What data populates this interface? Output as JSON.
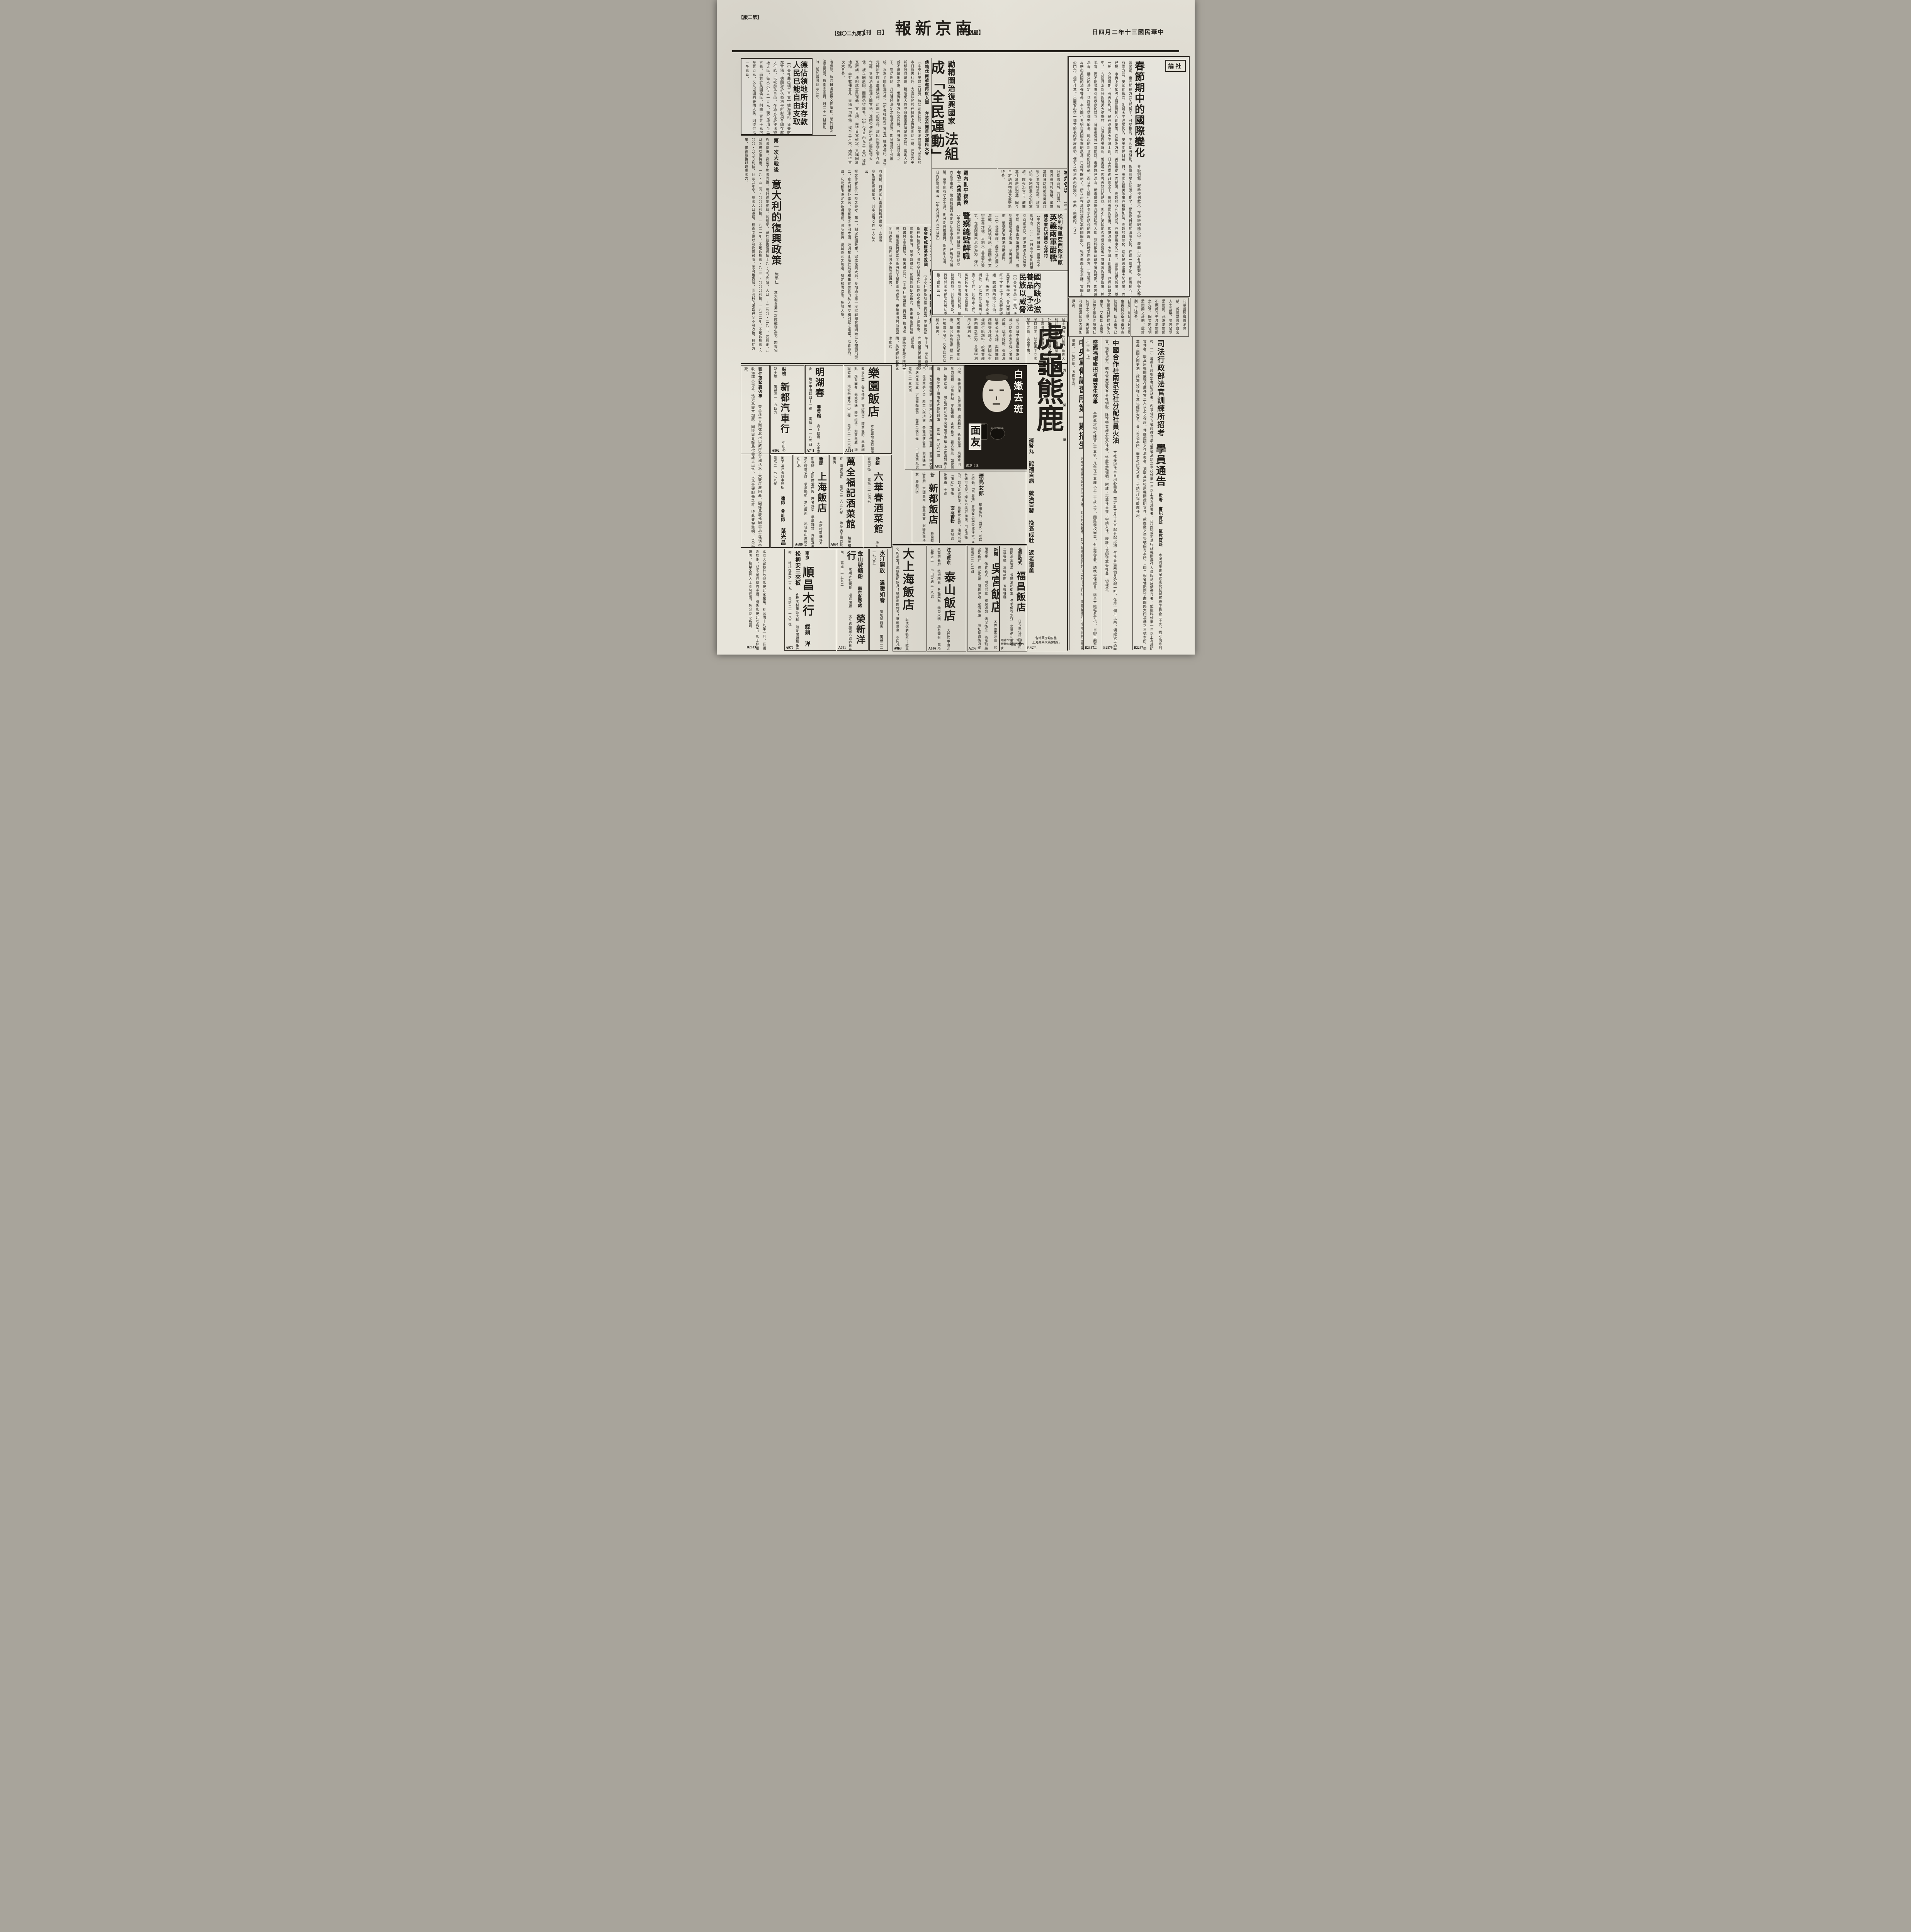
{
  "page": {
    "edition": "【版二第】",
    "issue": "【號〇二九第】",
    "daily": "【刊　日】",
    "masthead": "報新京南",
    "weekday": "【二期星】",
    "date": "日四月二年十三國民華中"
  },
  "editorial": {
    "label": "論社",
    "title": "春節期中的國際變化",
    "body": "春節例假、報紙停刊數天、在短短的幾天中、表面上沒有什麼緊張、則各方都非常緊張、重要的幾方面的局勢中、可以推測、不久便將發動、觀察歐局的決勝之期了、是歐局目前的決勝大勢、在這一個季節、德義軸心、祇有兩方面、英國的戰面、則是太平洋局勢的。英美關係日甚一日、美國的援英政策亦積極加強、而趨於白熱化。這便是甚麼重大的結果、內亂已極、事實上更加強了羅國對軸心的依附。在歐洲方面、英國縱使一面稱勝、而趨於有利的局面、亦祇是戰事的一面、三國同盟的效果、並非一朝一夕所可期、英美的利益、是在遠東與太平洋上的。日本在南進政策之下、對於美國的態度、頗堪注意、太平洋上的風雲、已在醞釀之中。一方面日本新任的駐美大使野村、已兼程赴美履新、他抱着一腔與美修好的熱忱、但不知美國能否覺悟改變他一貫陳舊的遠東政策、抓住現實、而不阻撓東亞新秩序的建立、目前卻還是一個問題。春節旣已過去、新春隨着陽光而駕臨到人間、預料歐洲醞釀準備的時期、卽將成爲過去、勝負的決定、也許就在這個季節裏、軸心的新攻勢卽將發動、而日本方面也處處表示出積極的態度、同時東西兩方、正是遙相呼應、更反映出美國的加強援英、本方面也看明白英國未來的厄運、已經在眼前了。所以說在這短短幾天裏的國際變化、雖然表面上很平靜、實際上鈎心鬥角、極可注意。只要留心這一個季節裏的發展形勢、便可以知道未來的變化、是未可樂觀的。（Ｊ）"
  },
  "news": {
    "german": {
      "t1": "德佔領地所封存款",
      "t2": "人民已能自由支取",
      "body": "【中央社華盛頓三日電】據海通訊、據美財部宣稱、德國對於佔領地帶所封鎖各國存款之付給、已較前爲自由、在過去住於被佔領地人民、每人只付以一百元、現已增加至二百元、而對於美國僑民、則由二百五十元增至五百元、又凡返國的美國人民、則特付以一千元云、"
    },
    "wirea": {
      "body": "海通訊、據昨日法報撰文佈論稱、關於首次法國民議、鉄衛團團員、月二十一日暴動時、前於曾將計三〇年。"
    },
    "italy": {
      "kicker": "第一次大戰後",
      "title": "意大利的復興政策",
      "author": "施學仁",
      "body": "意大利自第一次歐戰發生後、卽與協約國聯絡、背棄了三國同盟、而對德奧宣戰、其結果、得於戰後獲得領土九・〇〇五哩、人口一・三七〇・二九一、宣戰後、其財政賴以維持者、一九・五三四・〇〇〇利拉、一九二一年、不足數爲五・九二二・〇〇〇利拉、一九二二年、不足數爲五・〇〇〇・〇〇〇利拉、計三〇年來、意國人口激增、糧食問題以及物價飛漲、國府雖告誡、而消耗的遷延已至不可收拾、對症方策、俟復戰後以培養國力、",
      "body2": "撰文作者並供一時之參考、第一、制定救國政策、完成復興大局、參加過之第一次歐戰和食糧問題以及物價飛漲、二、意大利旅外僑民、常有鉅金匯回本國、近因禁止屬於娛樂和集會性質的私人房屋和別墅之建築、以資節約、四、凡元首所決定之各項措置、同時並供一復興作者之無過、制定救國政策、參加大局、"
    },
    "france": {
      "kicker": "勵精圖治復興國家",
      "title": "法組成「全民運動」",
      "sub1": "傳賴伐爾被邀再度入閣",
      "sub2": "幷將召開首次國民大會",
      "body": "【中央社里昂二日電】據哈瓦斯社訊、法某消息靈通方面頃於本日發表社評、力言法民族在精神上實屬團結一致、巴黎若干報紙所持論調、雖或使人感覺自由區與淪陷區之間、兩地人民咸不無隔閡之處、但實則雙方完全諒解、在貝當元首領導之下、密切團結、凡元首所決定之各項措置、卽使性質十分嚴峻、亦爲全國所遵行云、【中央社維希三日電】據海通訊、貝當元帥原定昨日廣播演詞、討論一般政局、旋因巴黎發生事件而作罷、又據消息靈通方面宣稱、達朗公使原定赴巴黎晤德大使、旋以同原因、因而仍留維希、【中央社日內瓦二日電】據哈瓦斯講、法組成全民運動、會日期、尚待貝當確定、又稱關於地點、尚有數種意見、末稱一切準備、或至二月末、始舉行首次大會云、"
    },
    "rome": {
      "kicker": "羅內亂平復後",
      "title": "警察總監解職",
      "sub": "有功士兵感獲重獎",
      "body": "【中央社羅馬三日電】羅馬尼亞內亂平復後、警察總監以未能防止亂事發生、已被明令解職、至平亂有功之士兵、則分別感獲重獎、聞內閣人選、日內卽可發表云、【中央社日內瓦二日電】"
    },
    "denmark": {
      "t1": "丹國社黨",
      "t2": "黨徒增多",
      "body": "【中央社丹麥京城三日電】丹麥國社黨昨向丹麥政府宣稱、丹麥國社黨黨徒現已增多、去歲有參加暴動而被捕者、其中並有女性一人在內云、"
    },
    "willkie": {
      "t1": "威爾基訪視",
      "t2": "英被炸各城",
      "body": "【中央社瑞典京城三日電】據得自倫敦報告稱、威爾基昨日訪視被德機轟炸後之戈文特里城、旋又訪視受創頗重之伯明罕城、昨夜迄今日、威爾基住於羅斯烈堡、聞今日將訪利物浦及曼徹斯特云、"
    },
    "nutrition": {
      "t1": "國內缺少滋養品",
      "t2": "予法民族以威脅",
      "body": "【中央社里昂二日電】法某著名醫學家、曾向美國紅十字會工作人員發表談話、略謂國內缺少牛油、牛乳、朱古力、苟不設法補救、足以危及法蘭西民族之生存、其爲害之甚、將較數千年來之戰爭爲烈、故我國現行局勢、倘聽其自然、其影響所及、行見我國子孫陷於萬劫不復之境地云云、"
    },
    "eritrea": {
      "kicker": "埃利特里亞西部平原",
      "title": "英義兩軍酣戰",
      "sub": "傳英軍已佔據亞戈達特",
      "body": "【中央社羅馬三日電】義軍司令部發表、（一）一日東非埃利特里亞西部平原、阿戈爾達多已倫支中間、我軍與英軍展開激戰、義空軍援助地上義軍、以機槍掃射、擊潰英軍陣地移動部隊、（二）北非戰線、義軍在巴爾之激戰、又路透社訊、此間宣布英空軍轟炸機、星期六日冒惡劣天氣、復襲阿爾巴尼亞海港、彈中倉庫與軍火庫等目標、"
    },
    "donovan": {
      "kicker": "美特使鄧洛文",
      "title": "留土京候晤總統",
      "sub": "霍金斯威爾基將返國",
      "body": "【中央社伊斯坦堡三日電】美總統羅斯福特使鄧洛文、將於今日與土外長作首次會談、及土總統事、統伊斯麥時、尚不致離此、謠傳鄧特使之留此、係銜羅斯福總統持書與土國首領、故未離此云、【中央社華盛頓三日電】據海通訊、羅斯福特使霍金斯將於下星期由英返國、衆信渠將與威爾基同時返國、羅氏並將予彼等要職云、"
    },
    "pacific": {
      "kicker": "共同防衛南太平洋",
      "title": "美澳新已成立諒解",
      "body": "【中央社紐約三日電】「紐約泰晤士報」載稱、美澳新西蘭間、似已成立以日本南進政策爲目標之防衛南太平洋之某種諒解、此項諒解、係澳洲駐美公使克錫、與赫爾國務卿交涉成功、美國似有權利供給燃料、設備東部新西蘭之軍港、並獲得利用之權利云、"
    },
    "airwar": {
      "title": "英領空又有猛戰",
      "body": "【中央社瑞典京城三日電】據英國廣播公司宣稱、英吉利海峽及英格蘭南岸、發生激烈空戰、詳情未悉、【中央社柏林二日電】德軍司令部發表稱、德空軍一日又空襲英本土、轟炸空軍根據地兩處、炸毀敵轟炸機多架、此外轟炸英格蘭東南部重要軍事目標、擊沉英商船三艘（共計萬四千噸）、又予其餘以極大損害、"
    },
    "manchu": {
      "t1": "滿洲駐義大使",
      "t2": "前日呈遞國書",
      "body": "【中央社羅馬二日電】滿洲國新任駐義公使羅振邦、二日上午十時、至納萊宮、向義皇愛麥棱三世呈遞國書、"
    },
    "ships": {
      "t1": "美將沒收",
      "t2": "軸心船舶",
      "body": "【中央社紐約一日電】美將於最近沒收停泊美港之軸心國船舶、近因義國僑民常有鉅金匯回本國、美政府對此甚爲注意云、"
    },
    "genoa": {
      "kicker": "義方鄭重否認",
      "title": "封閉熱那亞港",
      "body": "【中央社瑞士京城三日電】據義大利駐外使館鄭重否認稱、外報所稱熱那亞港、西地中海將有戰事發生、義將予以封閉、禁止與中立國船舶之說、完全不確、"
    },
    "gusang": {
      "kicker": "谷桑將軍表明",
      "title": "瑞士國防雄厚",
      "body": "【中央社瑞士京城三日電】據瑞士最高軍事長官谷桑將軍發表談話稱、瑞士軍隊已準備應付任何可能的事態、又稱瑞士軍隊決無不抵抗而放棄任何領土之意、末稱渠可自信其國防力量加厚矣、"
    },
    "whitehouse": {
      "kicker": "白宮人士盛傳",
      "title": "英將佔愛爾蘭",
      "body": "【中央社紐約三日電】據昨晚「紐約詢報」刊華盛頓傳來消息稱、威爾基曾向白宮人士宣稱、英將佔領愛爾蘭、此爲愛爾蘭不願威氏干涉愛爾蘭之先聲、聞英將佔領愛爾蘭之計劃、此計劃已打消云、"
    }
  },
  "notices": {
    "judicial": {
      "t1": "司法行政部法官訓練所招考",
      "t2": "學員通告",
      "roles": "監考　書記官班　監獄官班",
      "body": "本所招考書記官班及監獄官班學員各三十名、招考簡章列後、（一）等學力經檢定考試及格者、丙曾在公立或經教育部立案或承認之學校修業一年以上得有證書者、已法院或司法行政機關委任人員服務成績優良者、監獄科修業一年以上有證明文件者、取具原機關或現任薦任官二人以上之保證、件應證明文件遺失者、須取具原校原機關證明文件、款應繳文憑掛號函寄本所、（四）報名地點南京瞻園路大四福巷之三號本所、甲黨義乙國文丙史地丁政治戊法律大意已經濟大意、員可寄宿本所、畢業考試及格者、呈請司法行政部任用、",
      "code": "B2257"
    },
    "coop": {
      "title": "中國合作社南京支社分配社員火油",
      "body": "本社專辦社員日用必需品、茲定於本月十八日起分配火油、每社員每兩個月分配一听、在第一個月以內、領證後以憑購買、現暫規定、聽在營業部及各分社領取、除在營業部及各分社外、特此登報週知、附註：再非社員亦可申請入社、經許可後卽得享受社員一切權益、",
      "code": "B2879"
    },
    "shengxifu": {
      "title": "盛錫福帽廠招考練習生啓事",
      "body": "本廠此次招考練習生十五名、凡年在十五歲以上二十歲以下、國民學校畢業、有志學習者、請携帶保證書、逕至本廠報名可也、自卽日起至一月十五日止、",
      "code": "B2357"
    },
    "institute": {
      "title": "中央宣傳講習所第一期招生",
      "body": "凡中學畢業或具有同等學力者、均可報名投考、報名日期自卽日起至二月十五日止、附繳最近四寸半身照片及畢業證書、一切詳章、函索卽寄、"
    }
  },
  "ads": {
    "tiger": {
      "c1": "虎",
      "c2": "龜",
      "c3": "熊",
      "c4": "鹿",
      "i1": "富",
      "i2": "貴",
      "i3": "榮",
      "i4": "華",
      "pill": "補腎丸",
      "s1": "能補百病",
      "s2": "統治百發",
      "s3": "挽衰成壯",
      "s4": "返老還童",
      "f1": "各埠藥房均有售",
      "f2": "上海美藥大藥房發行",
      "code": "B2575"
    },
    "face": {
      "headline": "白嫩去斑",
      "brand": "面友",
      "jar": "FACE FRIEND",
      "agent": "南京代理",
      "sub": "面友香粉"
    },
    "facetext": {
      "title": "漂亮女郎",
      "body": "都用搽的「面友」、以其之特長。「白裏仙」專除雀斑與吸收偉大。非普通可比擬。婦女不笑容滿面。用老牌搽的、製成香濃粉淨、另有雪花膏、油光已用「面友」卽搽、",
      "shop": "甯記號　建康路二十號"
    },
    "leyuan": {
      "name": "樂園飯店",
      "details": "本社專辦應時筵席　改良和菜　各省佳餚　零折碗菜　隨意便酌　早晨細點　應有盡有　蘇滬秀姝　隨堂招待　如蒙惠顧　竭誠歡迎",
      "addr": "地址朱雀路一〇三號",
      "phone": "電話二一二六四",
      "code": "A524"
    },
    "minghu": {
      "name": "明湖春",
      "type": "粵菜館",
      "details": "高上筵席　大小宴會",
      "addr": "地址中山路四十一號",
      "phone": "電話二一一八五四",
      "code": "A741"
    },
    "autocar": {
      "label": "鼓樓",
      "name": "新都汽車行",
      "addr": "中山北路十號",
      "phone": "電話三一一九四九",
      "code": "A802"
    },
    "zhang": {
      "title": "張仲䓬緊要啓事",
      "body": "查坐落本京西郊北河口對岸永定洲活水十六號房屋田產、間經馬慶延同弟馬士浩憑中收過鄒人租賃、浩更爲變本加厲、聞欲與其姪馬松雲託人出售、以爲金蟬脫壳之計、特此登報聲明、以免受欺、"
    },
    "shuangye": {
      "name": "双葉閩菜社",
      "details": "閩菜首都獨一　極備福建風味　常有各種海鮮　定辦大小酒席　藉資宣傳營業　價目極力克已　崔揚拿手之菜　和菜小吃均備　各色福建名品　價廉味美　禮送用此尤宜　定做壽麵壽飽　從早至晚常備",
      "addr": "中山路四九號",
      "phone": "電話二一三六四"
    },
    "houdefu": {
      "label": "北京分此",
      "name": "厚德福",
      "type": "酒樓",
      "details": "敝樓特點　經濟小吃　味美價廉　眞正塡鴨　維新和菜　珍貴筵席　燒烤羊肉　羊肉涮鍋　早晨茶點　零整烤鴨　北京名菜　著名豫菜　如蒙惠顧　無任歡迎",
      "note": "附告如有以前中央商場厚德福之席票請到夫子廟",
      "addr": "地址夫子廟南京大戲院對面",
      "phone": "電話二三〇六一號",
      "code": "A802"
    },
    "xindou": {
      "label": "新",
      "name": "新都飯店",
      "details": "特聘超等名廚　烹調高尚　各界宴會　婀娜蘇滬侍女　殷勤招待"
    },
    "dashanghai": {
      "name": "大上海飯店",
      "details": "近代化的裝飾！歐美化的浴堂！流線型的傢具！練訓過的侍者！華麗畓皇　不同凡響",
      "code": "A763"
    },
    "taishan": {
      "label": "注北意京",
      "name": "泰山飯店",
      "details": "大行宮中由北京聘來名廚　技術精良　各種菜點　精益求精　應有盡有　眞乃首都大王",
      "addr": "中山東路三二八號",
      "code": "A636"
    },
    "wugong": {
      "label": "新開",
      "name": "吳宮飯店",
      "details": "各界旅客注意　房間優美　佈置新式　附設浴室　禮貌週到　清潔衛生　茶房訓練　空氣新鮮　體堂富麗　開幕伊始　定價低廉",
      "addr": "地址慧園街四號",
      "phone": "電話二二九二四",
      "code": "A256"
    },
    "fuchang": {
      "name": "福昌飯店",
      "label": "全部歐式",
      "note": "日金單位法幣通用",
      "details": "房間浴室清潔　餐廳酒吧衛生　冬季備有水汀　交通便利適中　二樓餐廳　三樓旅館　五樓餐廳",
      "phones": "電話22577　電話23372　電話23373",
      "addr": "南京中山路五十七號"
    },
    "shanghainew": {
      "label": "新開",
      "name": "上海飯店",
      "details": "本店特聘蘇錫名廚專辦　高尚席堂佳製　著名錫菜　早晨麵點　喜慶宴會　無不精益求精　承蒙賜顧　無任歡迎",
      "addr": "地址中山東路土街口北",
      "code": "A680"
    },
    "wanquan": {
      "name": "萬全福記酒菜館",
      "details": "精美禮券　贈送最宜",
      "phone": "電話二三六五八號",
      "addr": "地址夫子廟貢院東街",
      "code": "A694"
    },
    "liuhuachun": {
      "label": "浙紹",
      "name": "六華春酒菜館",
      "addr": "地址貢院東街",
      "phone": "電話二一七四七"
    },
    "yeguangchang": {
      "firm": "衡平法律會計事務所",
      "roles": "律師　會計師",
      "name": "葉光昌",
      "phone": "電話二一七七九號"
    },
    "shunchang": {
      "place": "南京",
      "name": "順昌木行",
      "line": "經銷　洋松柳安三夾板",
      "details": "各種木材建築大料　如蒙賜顧無任歡迎",
      "addr": "地址復興路一三九",
      "phone": "電話二一一八三號",
      "code": "A970"
    },
    "rongxin": {
      "product": "金山牌麵粉",
      "place": "南京批發處",
      "name": "榮新洋行",
      "details": "常期大批現貨　迎歡賜顧",
      "addr": "太平路緯里六號春日莊內",
      "phone": "電話二一五九二",
      "code": "A791"
    },
    "shuiting": {
      "line1": "水汀開放",
      "line2": "溫暖如春",
      "addr": "地址慧圓街",
      "phone": "電話二二一七〇五"
    },
    "bottomleft": {
      "body": "本京大當巷廿七號馬慶延家產業、於民國十九年一月、巨測收款後、延不履行期約手續、關係馬慶延以病故、馬士登報聲明、務希各界人士幸勿誤購、致涉交涉爲要、",
      "code": "B2633"
    }
  }
}
